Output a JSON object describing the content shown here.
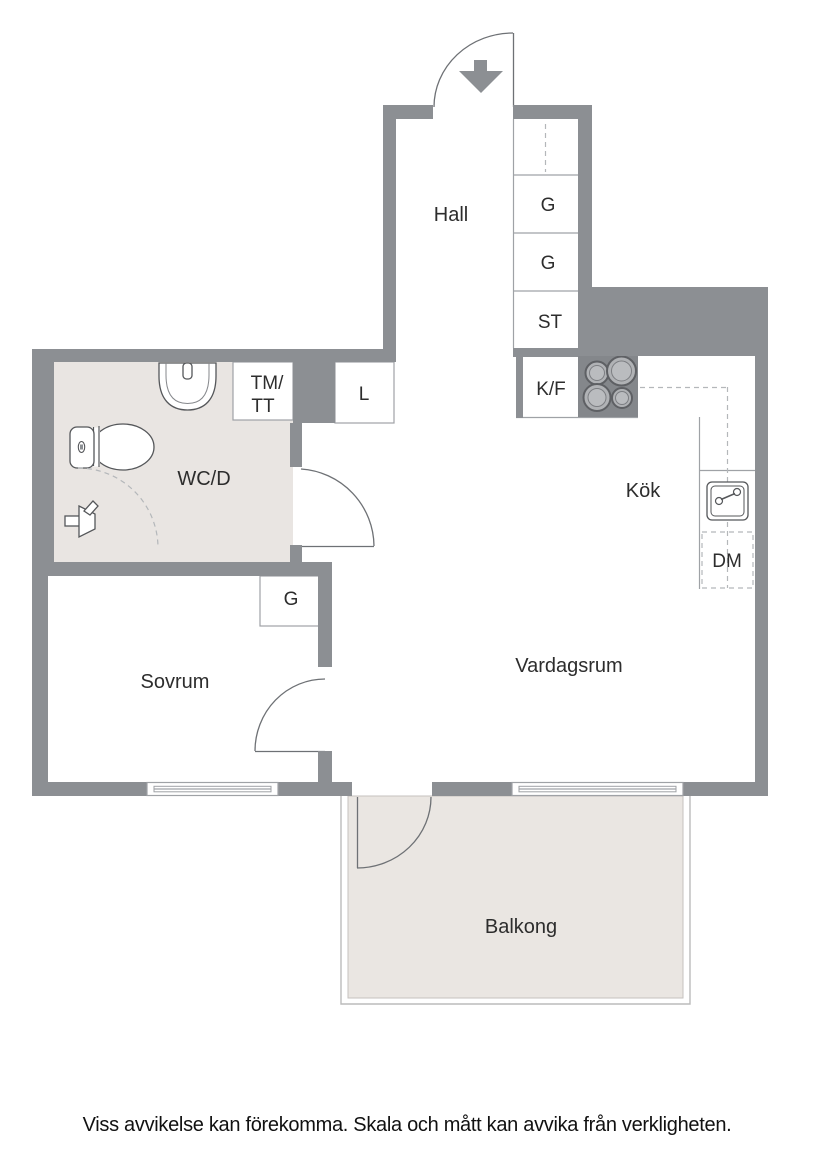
{
  "rooms": {
    "hall": "Hall",
    "bathroom": "WC/D",
    "bedroom": "Sovrum",
    "living_room": "Vardagsrum",
    "kitchen": "Kök",
    "balcony": "Balkong"
  },
  "storage": {
    "wardrobe_top": "G",
    "wardrobe_mid": "G",
    "closet": "ST",
    "linen": "L",
    "bedroom_wardrobe": "G"
  },
  "appliances": {
    "fridge_freezer": "K/F",
    "dishwasher": "DM",
    "washer_line1": "TM/",
    "washer_line2": "TT"
  },
  "footer": {
    "disclaimer": "Viss avvikelse kan förekomma. Skala och mått kan avvika från verkligheten."
  },
  "colors": {
    "wall": "#8c8f93",
    "wet_room_floor": "#e9e5e2",
    "balcony_floor": "#eae6e2",
    "thin_line": "#9fa2a6",
    "fixture_outline": "#55575a",
    "label_text": "#2d2d2d"
  }
}
